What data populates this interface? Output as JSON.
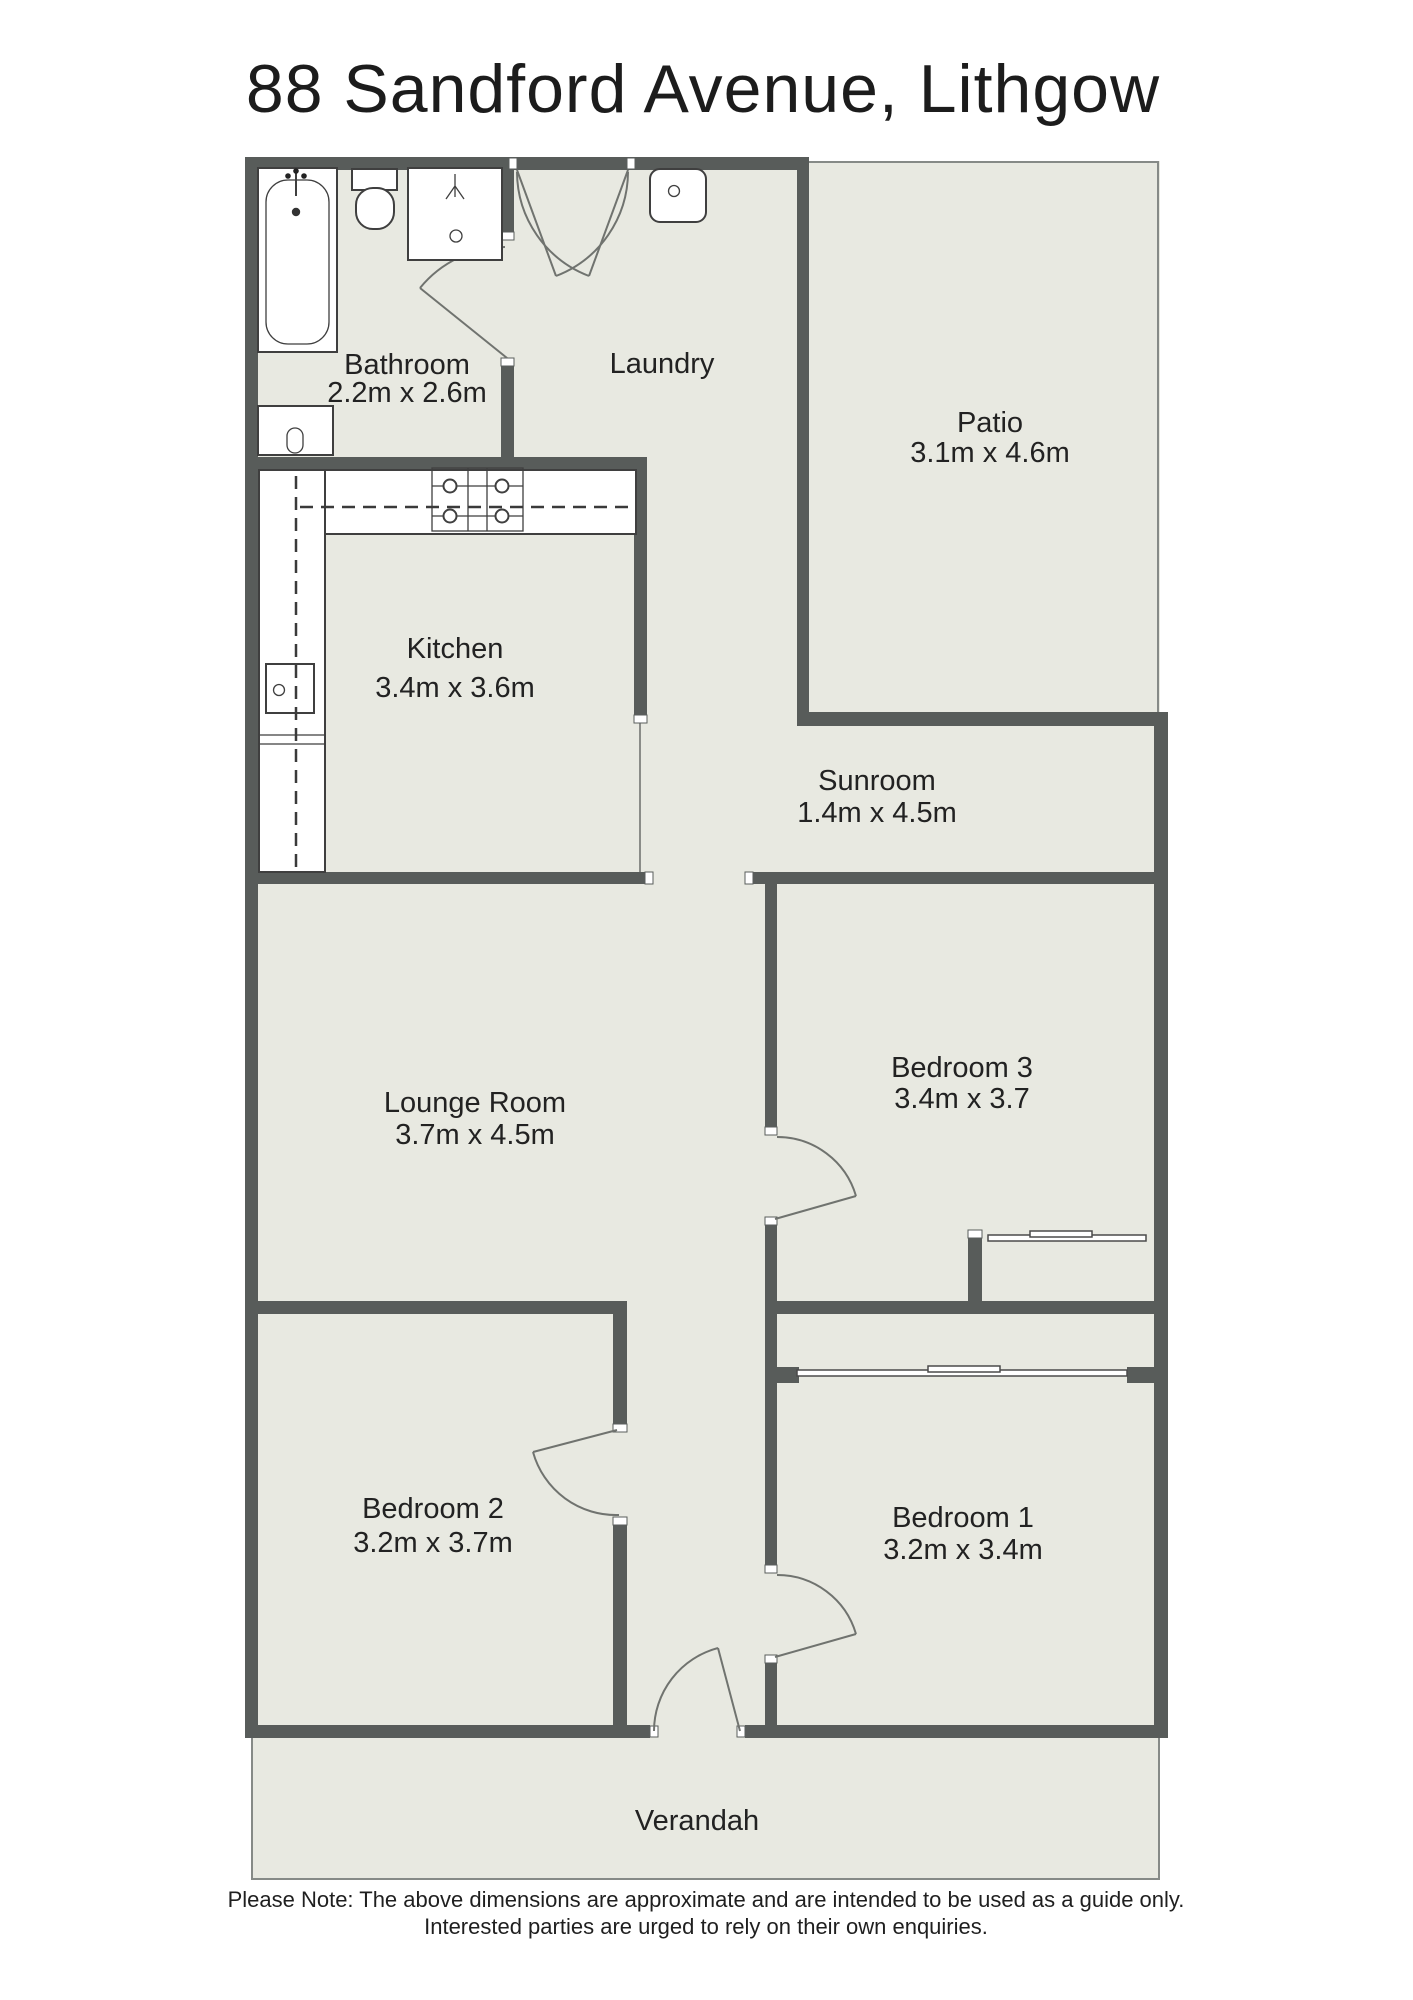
{
  "title": "88 Sandford Avenue, Lithgow",
  "note": {
    "line1": "Please Note: The above dimensions are approximate and are intended to be used as a guide only.",
    "line2": "Interested parties are urged to rely on their own enquiries."
  },
  "rooms": {
    "bathroom": {
      "name": "Bathroom",
      "dims": "2.2m x 2.6m"
    },
    "laundry": {
      "name": "Laundry"
    },
    "patio": {
      "name": "Patio",
      "dims": "3.1m x 4.6m"
    },
    "kitchen": {
      "name": "Kitchen",
      "dims": "3.4m x 3.6m"
    },
    "sunroom": {
      "name": "Sunroom",
      "dims": "1.4m x 4.5m"
    },
    "lounge": {
      "name": "Lounge Room",
      "dims": "3.7m x 4.5m"
    },
    "bedroom3": {
      "name": "Bedroom 3",
      "dims": "3.4m x 3.7"
    },
    "bedroom2": {
      "name": "Bedroom 2",
      "dims": "3.2m x 3.7m"
    },
    "bedroom1": {
      "name": "Bedroom 1",
      "dims": "3.2m x 3.4m"
    },
    "verandah": {
      "name": "Verandah"
    }
  },
  "colors": {
    "wall": "#585c5a",
    "floor": "#e8e9e1",
    "fixture_stroke": "#3f3f3f",
    "door_stroke": "#70736f",
    "text": "#222222"
  }
}
